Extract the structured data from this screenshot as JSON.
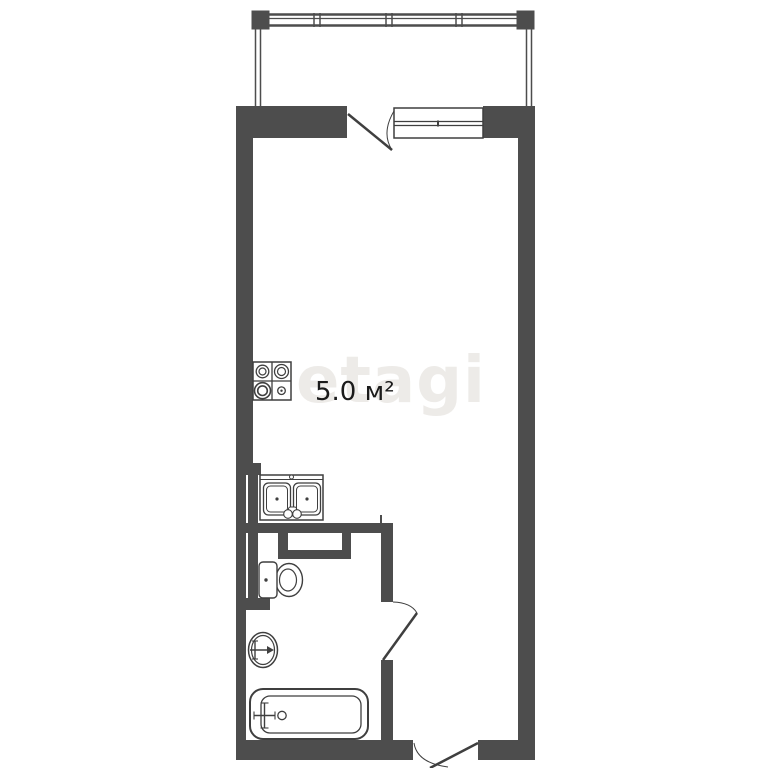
{
  "page": {
    "background": "#ffffff",
    "type_note": "apartment floor plan"
  },
  "watermark": {
    "text": "etagi",
    "color": "#edebe8"
  },
  "plan": {
    "area_label": "5.0 м²",
    "colors": {
      "wall": "#4d4d4d",
      "fixture_line": "#3f3f3f",
      "label_text": "#1b1b1b",
      "floor": "#ffffff"
    },
    "fixtures": [
      "balcony-glazing",
      "balcony-door",
      "window",
      "stove-4-burner",
      "kitchen-double-sink",
      "ventilation-shaft",
      "toilet",
      "round-wash-basin",
      "bathtub",
      "bathroom-door",
      "entrance-door"
    ]
  }
}
